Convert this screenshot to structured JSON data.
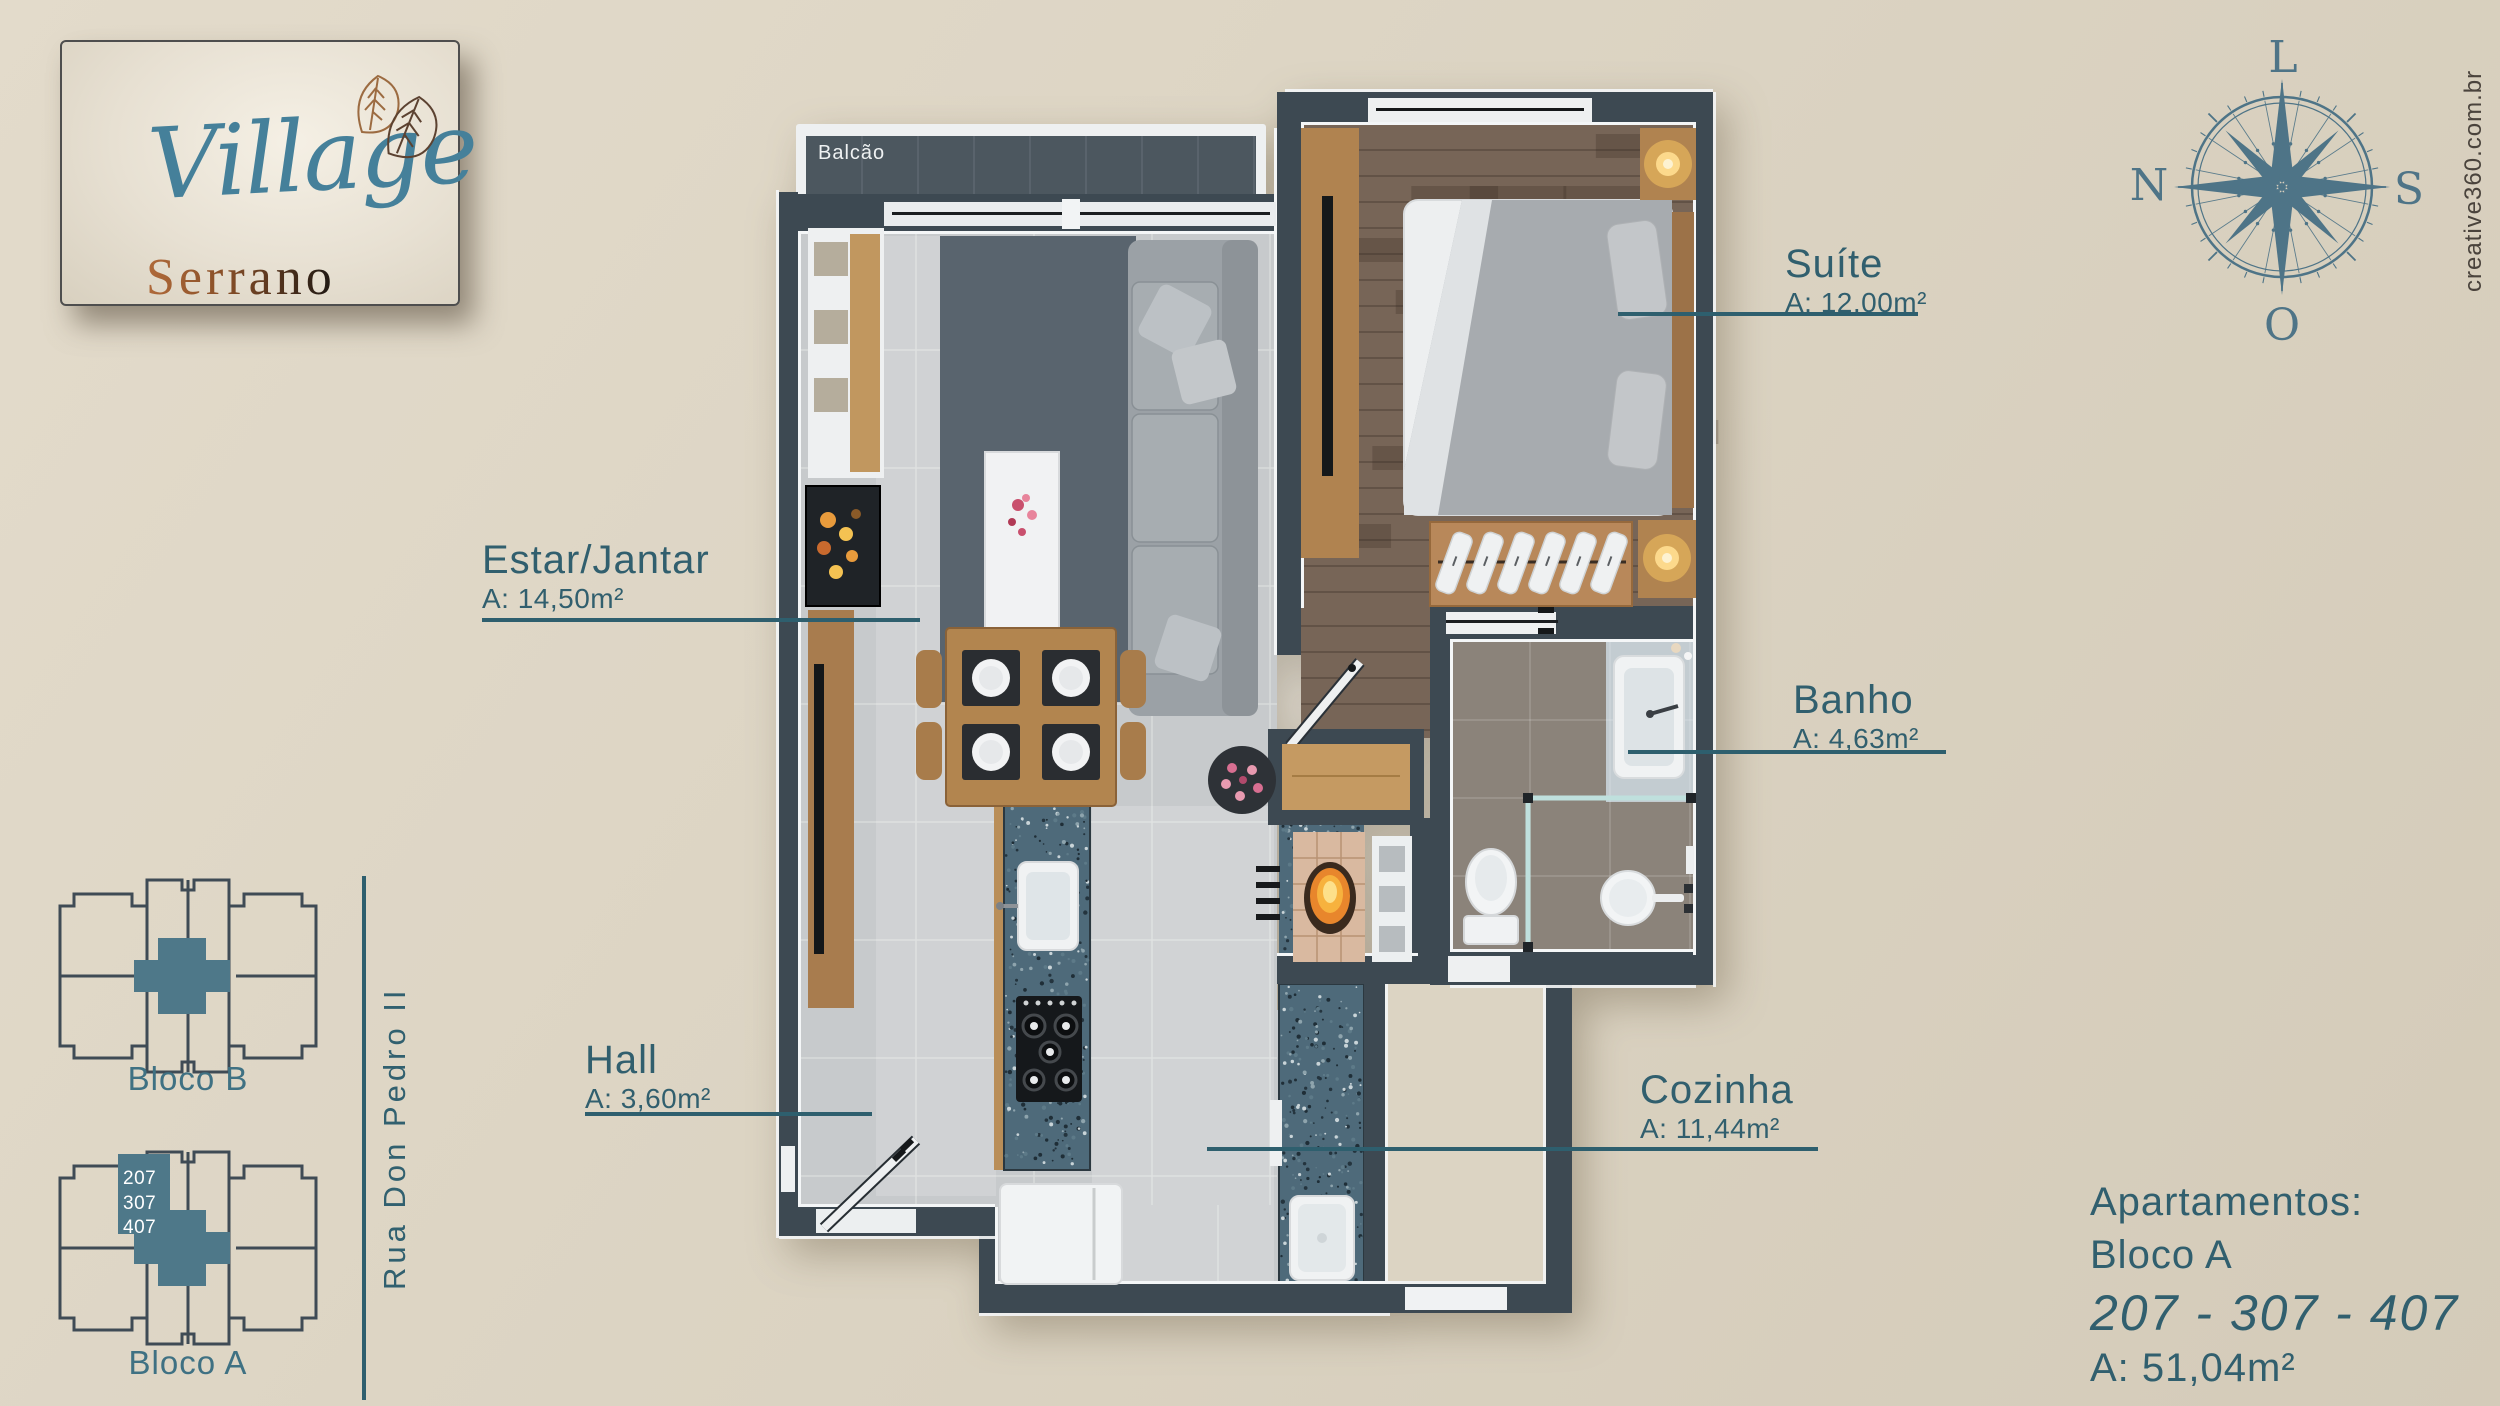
{
  "colors": {
    "background": "#dcd4c3",
    "accent_teal": "#2e5f6e",
    "wall": "#3d4952",
    "key_highlight": "#4e7889",
    "granite": "#4e6a7a",
    "wood": "#c0955f"
  },
  "logo": {
    "name": "Village",
    "subname": "Serrano"
  },
  "compass": {
    "east": "L",
    "north": "N",
    "south": "S",
    "west": "O"
  },
  "credit": "creative360.com.br",
  "plan": {
    "balcony": "Balcão",
    "rooms": [
      {
        "name": "Suíte",
        "area": "A: 12,00m²"
      },
      {
        "name": "Estar/Jantar",
        "area": "A: 14,50m²"
      },
      {
        "name": "Banho",
        "area": "A: 4,63m²"
      },
      {
        "name": "Hall",
        "area": "A: 3,60m²"
      },
      {
        "name": "Cozinha",
        "area": "A: 11,44m²"
      }
    ]
  },
  "key_plans": {
    "bloco_b": {
      "label": "Bloco B"
    },
    "bloco_a": {
      "label": "Bloco A",
      "units": [
        "207",
        "307",
        "407"
      ]
    },
    "street": "Rua Don Pedro II"
  },
  "info": {
    "line1": "Apartamentos:",
    "line2": "Bloco A",
    "numbers": "207 - 307 - 407",
    "area": "A: 51,04m²"
  }
}
